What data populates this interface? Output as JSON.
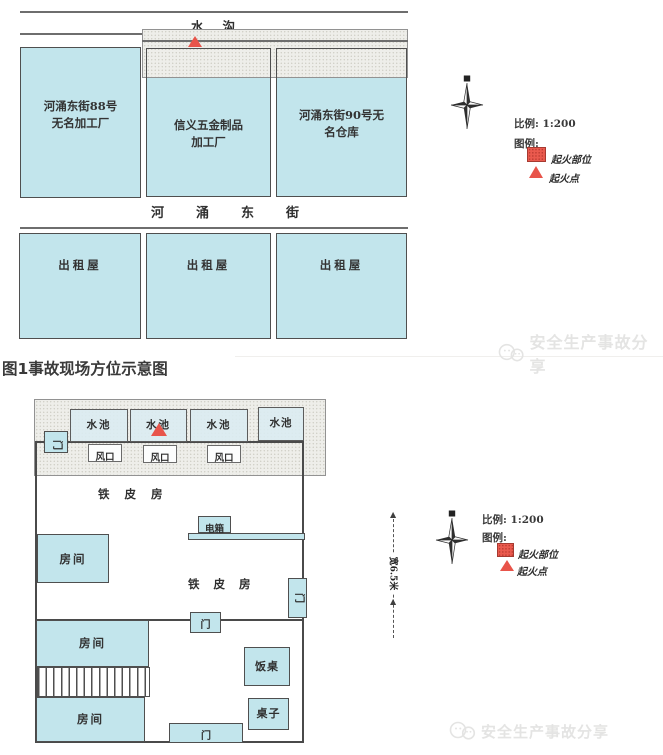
{
  "caption": "图1事故现场方位示意图",
  "watermark": {
    "text": "安全生产事故分享"
  },
  "colors": {
    "blue_fill": "#c2e5ec",
    "wall": "#4a4a4a",
    "fire_red": "#e8544a",
    "band_bg": "#eeeeea",
    "watermark_gray": "#e4e4e3"
  },
  "top": {
    "ditch": "水沟",
    "street": "河涌东街",
    "buildings": [
      {
        "line1": "河涌东街88号",
        "line2": "无名加工厂"
      },
      {
        "line1": "信义五金制品",
        "line2": "加工厂"
      },
      {
        "line1": "河涌东街90号无",
        "line2": "名仓库"
      }
    ],
    "rentals": [
      "出租屋",
      "出租屋",
      "出租屋"
    ],
    "legend": {
      "scale": "比例: 1:200",
      "title": "图例:",
      "item1": "起火部位",
      "item2": "起火点"
    }
  },
  "bottom": {
    "pools": [
      "水池",
      "水池",
      "水池",
      "水池"
    ],
    "vents": [
      "风口",
      "风口",
      "风口"
    ],
    "doors": {
      "left": "门",
      "right": "门",
      "middle": "门",
      "bottom": "门"
    },
    "rooms": [
      "房间",
      "房间",
      "房间"
    ],
    "iron_house": "铁皮房",
    "iron_house2": "铁皮房",
    "electric_box": "电箱",
    "dining_table": "饭桌",
    "table": "桌子",
    "dimension": "宽6.5米",
    "legend": {
      "scale": "比例: 1:200",
      "title": "图例:",
      "item1": "起火部位",
      "item2": "起火点"
    }
  }
}
